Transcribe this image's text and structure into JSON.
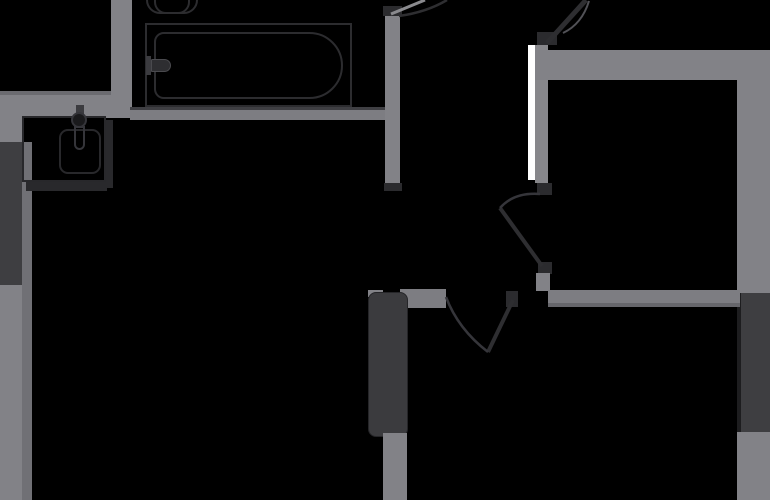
{
  "title": "apartment-floor-plan",
  "canvas": {
    "width": 770,
    "height": 500,
    "background": "#000000"
  },
  "colors": {
    "wall": "#828287",
    "wall_dark_edge": "#6b6b70",
    "wall_shadow": "#66666b",
    "window_glass": "#3e3e41",
    "door_jamb": "#2b2b2e",
    "fixture_outline": "#2c2c2f",
    "door_leaf": "#2e2e31",
    "door_panel_white": "#ffffff",
    "background": "#000000"
  },
  "rects": [
    {
      "name": "wall-exterior-top-left-edge",
      "x": 0,
      "y": 91,
      "w": 118,
      "h": 4,
      "bg": "#6b6b70"
    },
    {
      "name": "wall-exterior-top-left",
      "x": 0,
      "y": 95,
      "w": 130,
      "h": 23,
      "bg": "#828287"
    },
    {
      "name": "wall-exterior-left-upper",
      "x": 0,
      "y": 118,
      "w": 22,
      "h": 26,
      "bg": "#828287"
    },
    {
      "name": "window-left",
      "x": 0,
      "y": 142,
      "w": 22,
      "h": 143,
      "bg": "#3e3e41"
    },
    {
      "name": "wall-exterior-left-lower",
      "x": 0,
      "y": 285,
      "w": 22,
      "h": 215,
      "bg": "#828287"
    },
    {
      "name": "wall-exterior-left-inner-edge",
      "x": 22,
      "y": 142,
      "w": 10,
      "h": 358,
      "bg": "#707075"
    },
    {
      "name": "wall-bathroom-left",
      "x": 111,
      "y": 0,
      "w": 21,
      "h": 118,
      "bg": "#828287"
    },
    {
      "name": "wall-bathroom-bottom-edge",
      "x": 130,
      "y": 107,
      "w": 268,
      "h": 3,
      "bg": "#3f3f43"
    },
    {
      "name": "wall-bathroom-bottom",
      "x": 130,
      "y": 110,
      "w": 268,
      "h": 10,
      "bg": "#7d7d82"
    },
    {
      "name": "wall-bathroom-right",
      "x": 385,
      "y": 13,
      "w": 15,
      "h": 170,
      "bg": "#828287"
    },
    {
      "name": "jamb-bathroom-door-top",
      "x": 383,
      "y": 6,
      "w": 19,
      "h": 10,
      "bg": "#2b2b2e"
    },
    {
      "name": "jamb-bathroom-wall-bottom",
      "x": 384,
      "y": 183,
      "w": 18,
      "h": 8,
      "bg": "#2b2b2e"
    },
    {
      "name": "door-panel-white",
      "x": 528,
      "y": 45,
      "w": 7,
      "h": 135,
      "bg": "#ffffff"
    },
    {
      "name": "wall-bedroom-left",
      "x": 535,
      "y": 45,
      "w": 13,
      "h": 138,
      "bg": "#87878b"
    },
    {
      "name": "jamb-entry-door",
      "x": 537,
      "y": 32,
      "w": 20,
      "h": 13,
      "bg": "#2b2b2e"
    },
    {
      "name": "jamb-hall-door-top",
      "x": 537,
      "y": 183,
      "w": 15,
      "h": 12,
      "bg": "#2b2b2e"
    },
    {
      "name": "wall-bedroom-top",
      "x": 535,
      "y": 50,
      "w": 235,
      "h": 30,
      "bg": "#828287"
    },
    {
      "name": "wall-exterior-right-upper",
      "x": 737,
      "y": 50,
      "w": 33,
      "h": 243,
      "bg": "#828287"
    },
    {
      "name": "window-right-inner-gap",
      "x": 737,
      "y": 293,
      "w": 4,
      "h": 139,
      "bg": "#1d1d1f"
    },
    {
      "name": "window-right",
      "x": 741,
      "y": 293,
      "w": 29,
      "h": 139,
      "bg": "#3e3e41"
    },
    {
      "name": "wall-exterior-right-lower",
      "x": 737,
      "y": 432,
      "w": 33,
      "h": 68,
      "bg": "#828287"
    },
    {
      "name": "jamb-hall-door-bottom",
      "x": 538,
      "y": 262,
      "w": 14,
      "h": 12,
      "bg": "#2b2b2e"
    },
    {
      "name": "wall-bedroom-left-stub",
      "x": 536,
      "y": 273,
      "w": 14,
      "h": 18,
      "bg": "#828287"
    },
    {
      "name": "wall-mid-horizontal",
      "x": 548,
      "y": 290,
      "w": 192,
      "h": 13,
      "bg": "#7d7d82"
    },
    {
      "name": "wall-mid-horizontal-edge",
      "x": 548,
      "y": 303,
      "w": 192,
      "h": 4,
      "bg": "#66666b"
    },
    {
      "name": "wall-hall-bottom-stub",
      "x": 400,
      "y": 289,
      "w": 46,
      "h": 19,
      "bg": "#7d7d82"
    },
    {
      "name": "jamb-living-door",
      "x": 506,
      "y": 291,
      "w": 12,
      "h": 16,
      "bg": "#2b2b2e"
    },
    {
      "name": "wall-panel-cap",
      "x": 368,
      "y": 290,
      "w": 15,
      "h": 7,
      "bg": "#828287"
    },
    {
      "name": "panel-dark-glazed",
      "x": 368,
      "y": 292,
      "w": 40,
      "h": 145,
      "bg": "#3b3b3e",
      "radius": "8px",
      "border": "1px solid #252528"
    },
    {
      "name": "wall-bottom-mid",
      "x": 383,
      "y": 433,
      "w": 24,
      "h": 67,
      "bg": "#828287"
    },
    {
      "name": "bathtub-outer",
      "x": 145,
      "y": 23,
      "w": 207,
      "h": 84,
      "border": "2px solid #2c2c2f"
    },
    {
      "name": "bathtub-inner",
      "x": 154,
      "y": 32,
      "w": 189,
      "h": 67,
      "border": "2px solid #2c2c2f",
      "radius": "10px 34px 34px 10px"
    },
    {
      "name": "bathtub-faucet-base",
      "x": 146,
      "y": 56,
      "w": 5,
      "h": 19,
      "bg": "#3b3b3f"
    },
    {
      "name": "bathtub-faucet-spout",
      "x": 151,
      "y": 59,
      "w": 20,
      "h": 13,
      "bg": "#2e2e31",
      "radius": "2px 10px 10px 2px",
      "border": "1px solid #4a4a4e"
    },
    {
      "name": "toilet-outer",
      "x": 146,
      "y": -14,
      "w": 52,
      "h": 28,
      "border": "2px solid #2c2c2f",
      "radius": "0 0 14px 14px"
    },
    {
      "name": "toilet-inner",
      "x": 154,
      "y": -10,
      "w": 36,
      "h": 24,
      "border": "2px solid #2c2c2f",
      "radius": "0 0 12px 12px"
    },
    {
      "name": "sink-shadow-right",
      "x": 106,
      "y": 120,
      "w": 7,
      "h": 68,
      "bg": "#29292c"
    },
    {
      "name": "sink-shadow-bottom",
      "x": 26,
      "y": 182,
      "w": 81,
      "h": 9,
      "bg": "#29292c"
    },
    {
      "name": "sink-counter",
      "x": 22,
      "y": 116,
      "w": 84,
      "h": 66,
      "border": "2px solid #28282b"
    },
    {
      "name": "sink-bowl",
      "x": 59,
      "y": 129,
      "w": 42,
      "h": 45,
      "border": "2px solid #28282b",
      "radius": "9px"
    },
    {
      "name": "sink-faucet-stem",
      "x": 76,
      "y": 105,
      "w": 8,
      "h": 11,
      "bg": "#3b3b3f"
    },
    {
      "name": "sink-faucet-head",
      "x": 71,
      "y": 112,
      "w": 16,
      "h": 16,
      "border": "2px solid #35353a",
      "radius": "50%",
      "bg": "#1a1a1c"
    },
    {
      "name": "sink-faucet-spout",
      "x": 74,
      "y": 126,
      "w": 11,
      "h": 24,
      "border": "2px solid #35353a",
      "radius": "0 0 6px 6px"
    }
  ],
  "paths": [
    {
      "name": "bathroom-door-leaf",
      "d": "M 391 14 L 425 0",
      "stroke": "#8a8a8e",
      "w": 3
    },
    {
      "name": "bathroom-door-arc",
      "d": "M 399 16 Q 427 12 447 0",
      "stroke": "#2e2e31",
      "w": 2.5
    },
    {
      "name": "entry-door-leaf",
      "d": "M 547 43 L 586 0",
      "stroke": "#2e2e31",
      "w": 5
    },
    {
      "name": "entry-door-arc",
      "d": "M 563 33 Q 582 24 589 1",
      "stroke": "#515156",
      "w": 2
    },
    {
      "name": "hall-door-leaf",
      "d": "M 500 208 L 542 266",
      "stroke": "#2e2e31",
      "w": 4
    },
    {
      "name": "hall-door-arc",
      "d": "M 540 194 Q 514 192 500 208",
      "stroke": "#35353a",
      "w": 2.5
    },
    {
      "name": "living-door-leaf",
      "d": "M 513 300 L 488 352",
      "stroke": "#2e2e31",
      "w": 4
    },
    {
      "name": "living-door-arc",
      "d": "M 446 297 Q 458 329 488 352",
      "stroke": "#35353a",
      "w": 2.5
    }
  ]
}
